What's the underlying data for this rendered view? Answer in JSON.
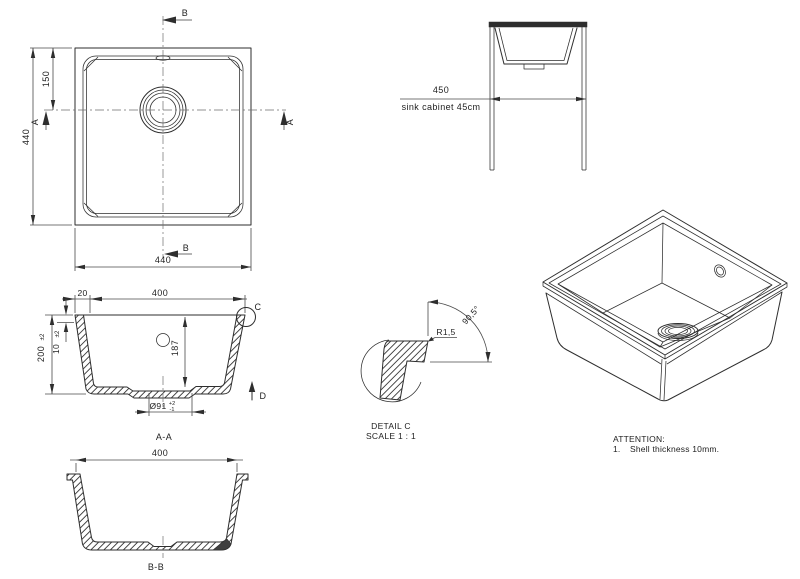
{
  "colors": {
    "line": "#2e2e2e",
    "dimension": "#4a4a4a",
    "text": "#222222",
    "background": "#ffffff"
  },
  "top_view": {
    "dim_height_left": "440",
    "dim_drain_offset": "150",
    "dim_width_bottom": "440",
    "section_a_left": "A",
    "section_a_right": "A",
    "section_b_top": "B",
    "section_b_bottom": "B"
  },
  "cabinet_view": {
    "dim_width": "450",
    "caption": "sink cabinet 45cm"
  },
  "section_aa": {
    "label": "A-A",
    "dim_wall_top": "20",
    "dim_inner_width": "400",
    "dim_height": "200",
    "dim_height_tol": "±2",
    "dim_shell": "10",
    "dim_shell_tol": "±2",
    "dim_depth": "187",
    "dim_drain": "Ø91",
    "dim_drain_tol_plus": "+2",
    "dim_drain_tol_minus": "-1",
    "detail_marker": "C",
    "direction_marker": "D"
  },
  "detail_c": {
    "radius_label": "R1,5",
    "angle_label": "90,5°",
    "title": "DETAIL C",
    "scale": "SCALE 1 : 1"
  },
  "section_bb": {
    "label": "B-B",
    "dim_width": "400"
  },
  "attention": {
    "title": "ATTENTION:",
    "item_number": "1.",
    "item_text": "Shell thickness 10mm."
  }
}
